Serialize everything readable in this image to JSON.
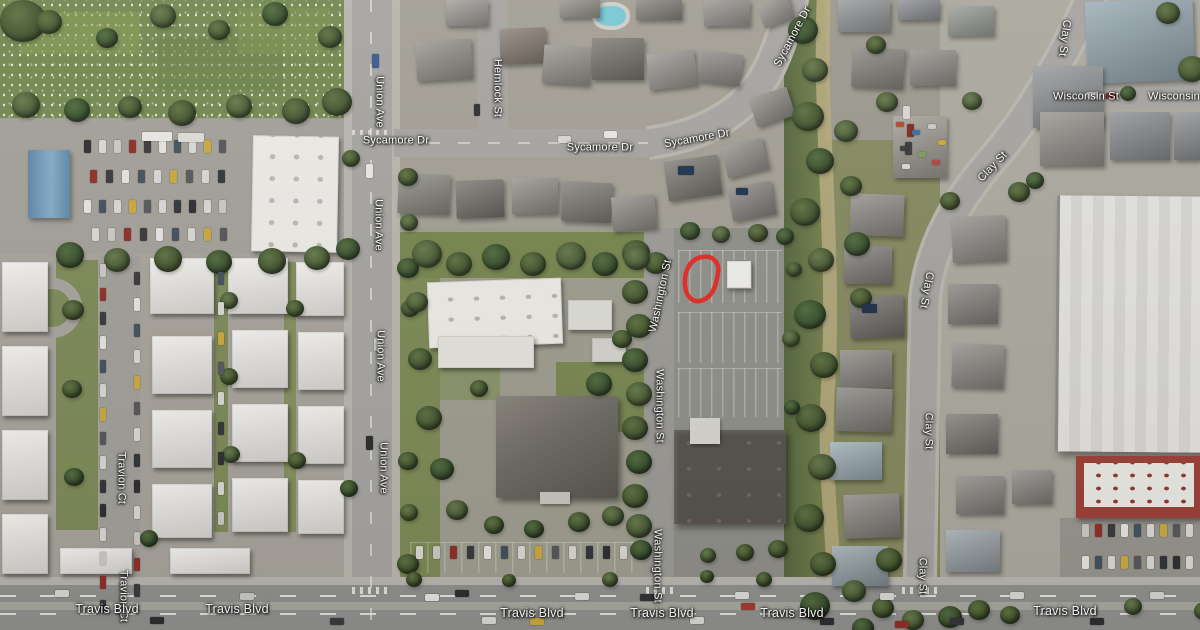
{
  "map": {
    "view": "satellite",
    "streets": {
      "sycamore_dr": "Sycamore Dr",
      "union_ave": "Union Ave",
      "hemlock_st": "Hemlock St",
      "washington_st": "Washington St",
      "travion_ct": "Travion Ct",
      "clay_st": "Clay St",
      "wisconsin_st": "Wisconsin St",
      "travis_blvd": "Travis Blvd"
    },
    "annotation": {
      "type": "hand-drawn-circle",
      "color": "#e8241d"
    },
    "colors": {
      "label_text": "#ffffff",
      "label_halo": "#000000"
    }
  }
}
